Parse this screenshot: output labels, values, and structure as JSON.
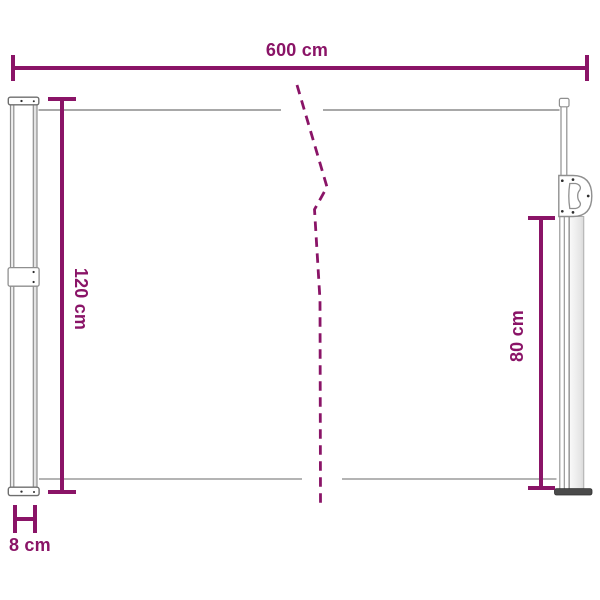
{
  "canvas": {
    "width": 600,
    "height": 600,
    "background": "#ffffff"
  },
  "colors": {
    "accent_magenta": "#8a1467",
    "fabric_line_gray": "#9c9c9c",
    "outline_gray": "#8f8f8f",
    "outline_dark_gray": "#6e6e6e",
    "casing_fill_light": "#ededed",
    "foot_dark": "#4a4a4a",
    "screw_dot": "#2f2f2f"
  },
  "dimensions": {
    "width": {
      "label": "600 cm",
      "orientation": "horizontal",
      "position": "top"
    },
    "height_left": {
      "label": "120 cm",
      "orientation": "vertical",
      "position": "left"
    },
    "height_right": {
      "label": "80 cm",
      "orientation": "vertical",
      "position": "right"
    },
    "depth": {
      "label": "8 cm",
      "orientation": "horizontal",
      "position": "bottom-left"
    }
  },
  "drawing": {
    "parts": [
      "left-cassette-pole",
      "awning-fabric-edges",
      "length-break-mark",
      "right-pull-pole",
      "pull-handle",
      "floor-foot"
    ]
  }
}
